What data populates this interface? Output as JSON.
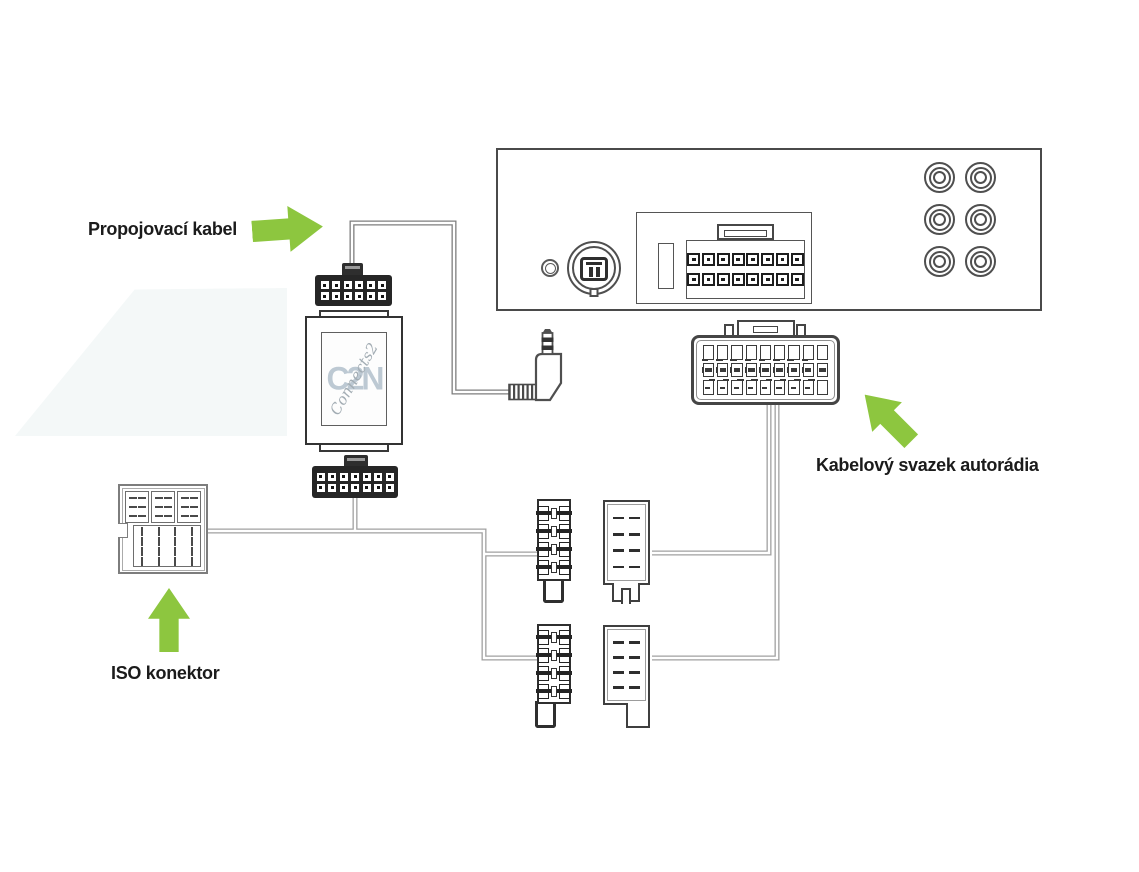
{
  "page": {
    "background": "#ffffff",
    "description": "car audio interface wiring diagram"
  },
  "labels": {
    "connector_cable": "Propojovací kabel",
    "radio_harness": "Kabelový svazek autorádia",
    "iso_connector": "ISO konektor"
  },
  "adapter": {
    "logo_letters": "C2N",
    "logo_script": "Connects2"
  },
  "colors": {
    "accent_green": "#8dc63f",
    "outline_dark": "#3a3a3a",
    "outline_gray": "#8f8f8f",
    "wire_gray": "#a0a0a0",
    "wire_dark": "#7e7e7e",
    "watermark_letters": "#bdc9d3",
    "watermark_script": "#a3adb4"
  },
  "icons": {
    "arrow_right": "block-arrow pointing right at adapter cable",
    "arrow_up_left": "block-arrow pointing up-left at radio harness plug",
    "arrow_up": "block-arrow pointing up at ISO connector"
  },
  "connectors": {
    "radio_main_pins": {
      "cols": 8,
      "rows": 2
    },
    "adapter_top_pins": {
      "cols": 6,
      "rows": 2
    },
    "adapter_bottom_pins": {
      "cols": 7,
      "rows": 2
    },
    "harness_terminals": {
      "cols": 9,
      "rows": 3
    },
    "male_iso_terminals": {
      "rows": 4
    },
    "female_iso_dashes": {
      "cols": 2,
      "rows": 4
    },
    "iso_power_blocks": 3,
    "iso_speaker_dashes": {
      "cols": 4,
      "rows": 4
    },
    "rca_jacks": 6
  }
}
